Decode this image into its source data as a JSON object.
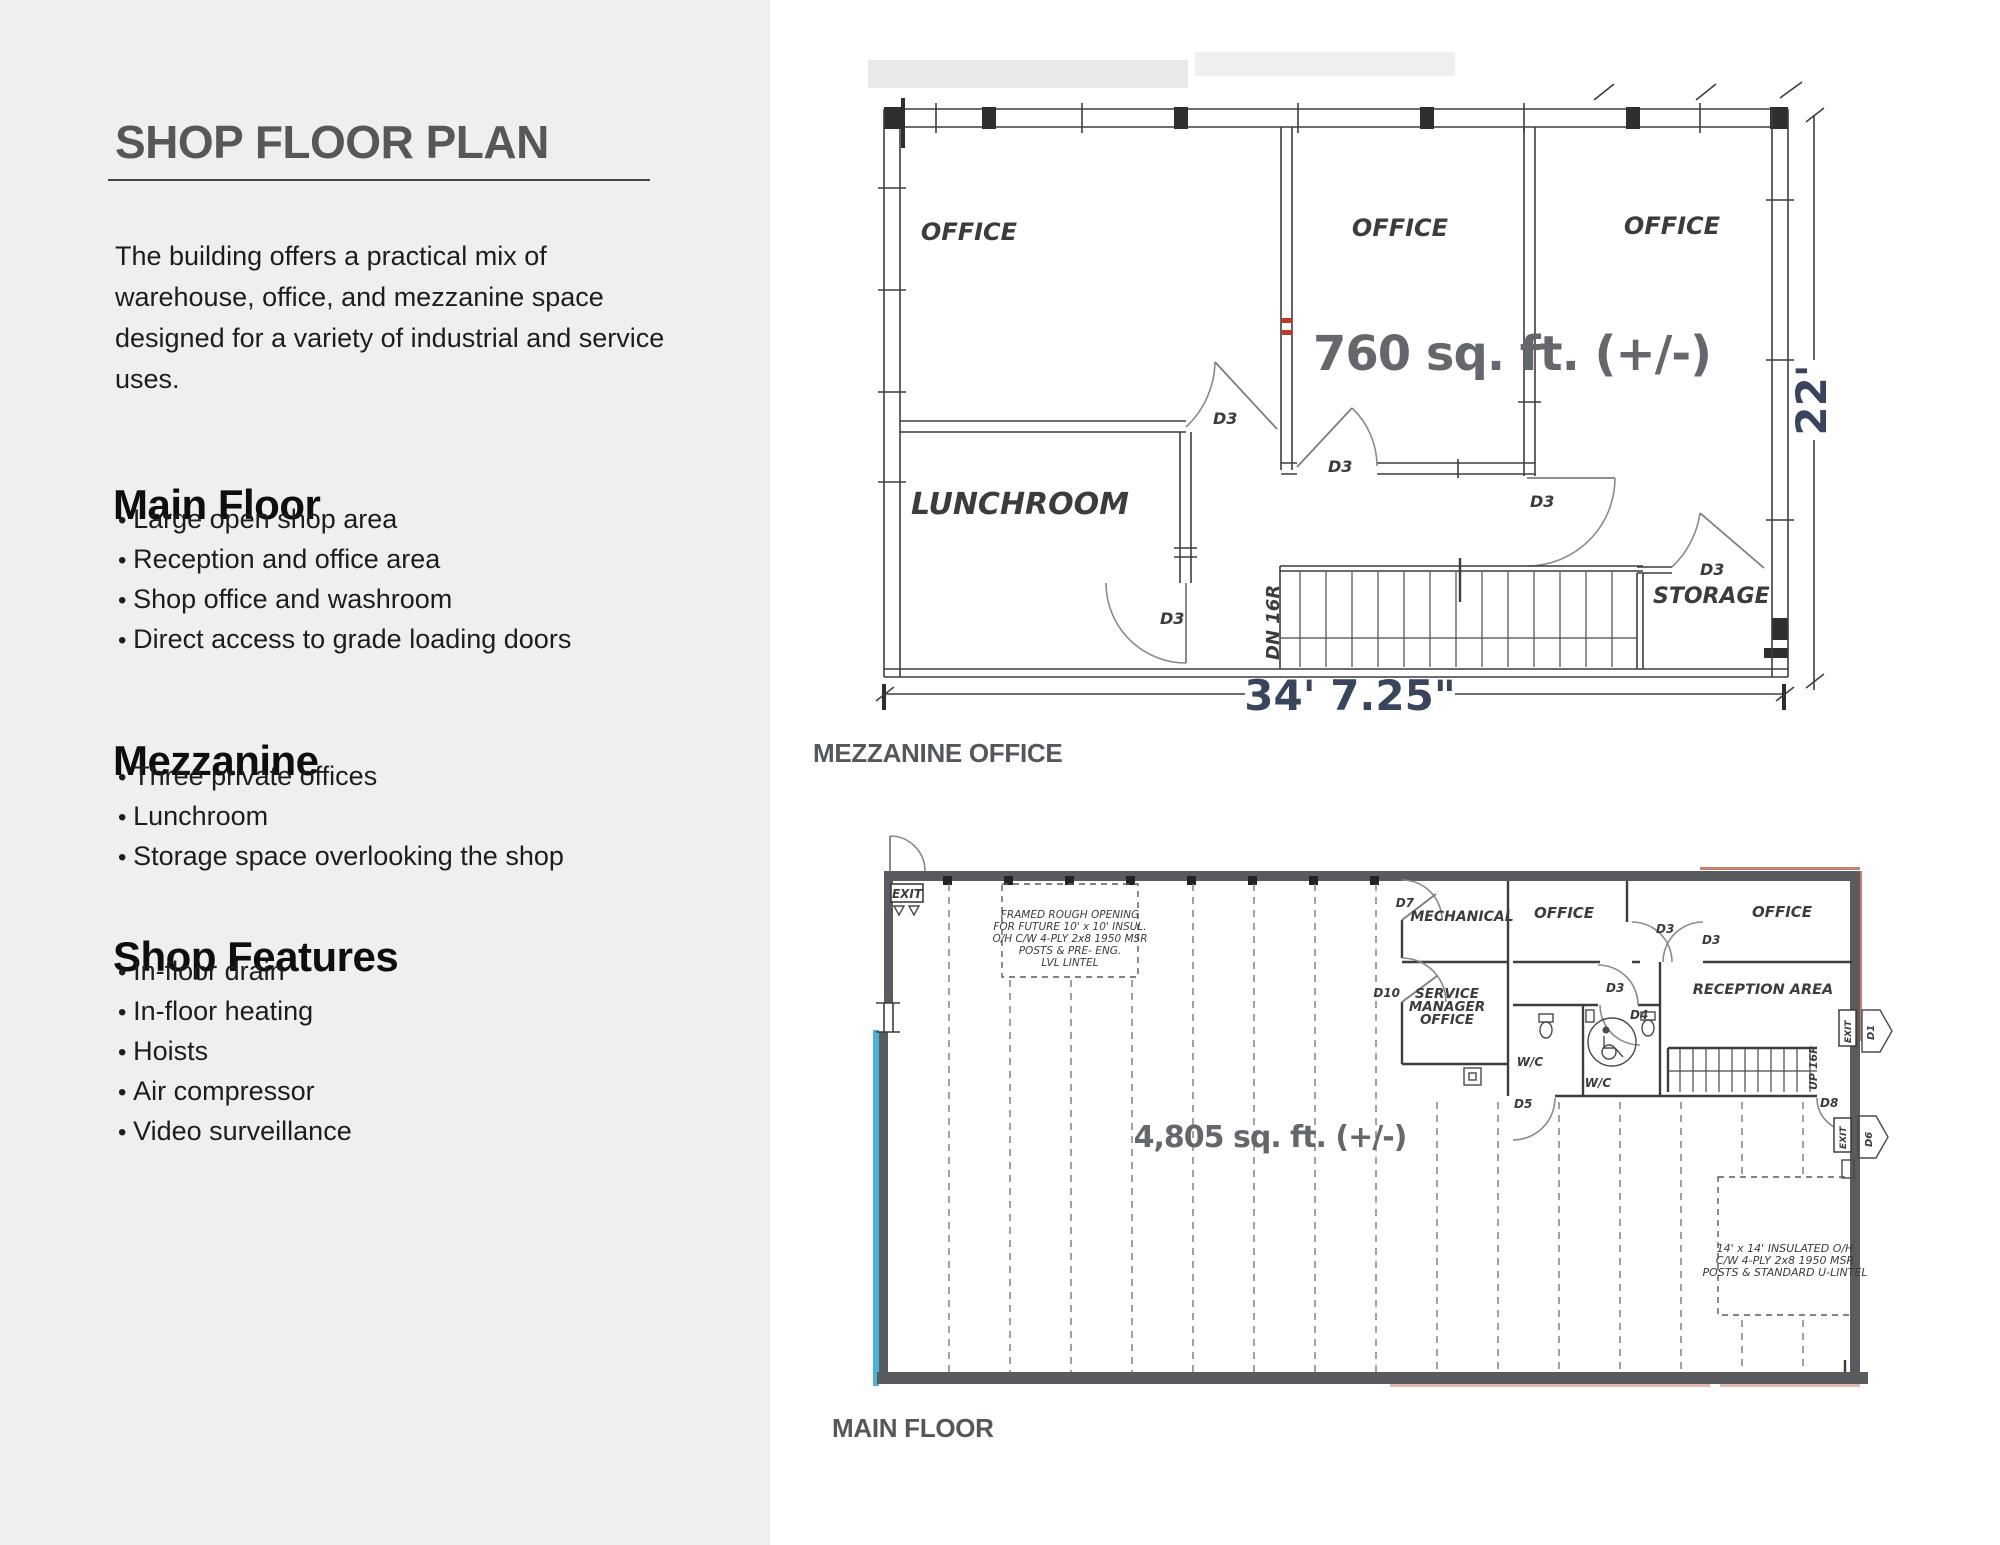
{
  "sidebar": {
    "title": "SHOP FLOOR PLAN",
    "intro_lines": [
      "The building offers a practical mix of",
      "warehouse, office, and mezzanine space",
      "designed for a variety of industrial and service",
      "uses."
    ],
    "sections": [
      {
        "heading": "Main Floor",
        "items": [
          "Large open shop area",
          "Reception and office area",
          "Shop office and washroom",
          "Direct access to grade loading doors"
        ]
      },
      {
        "heading": "Mezzanine",
        "items": [
          "Three private offices",
          "Lunchroom",
          "Storage space overlooking the shop"
        ]
      },
      {
        "heading": "Shop Features",
        "items": [
          "In-floor drain",
          "In-floor heating",
          "Hoists",
          "Air compressor",
          "Video surveillance"
        ]
      }
    ]
  },
  "doors": {
    "d1": "D1",
    "d3": "D3",
    "d4": "D4",
    "d5": "D5",
    "d6": "D6",
    "d7": "D7",
    "d8": "D8",
    "d10": "D10"
  },
  "mezzanine": {
    "caption": "MEZZANINE OFFICE",
    "area": "760 sq. ft. (+/-)",
    "offices": [
      "OFFICE",
      "OFFICE",
      "OFFICE"
    ],
    "lunchroom": "LUNCHROOM",
    "storage": "STORAGE",
    "stairs_label": "DN 16R",
    "width_dim": "34' 7.25\"",
    "height_dim": "22'"
  },
  "main_floor": {
    "caption": "MAIN FLOOR",
    "area": "4,805 sq. ft. (+/-)",
    "mechanical": "MECHANICAL",
    "service_office_lines": [
      "SERVICE",
      "MANAGER",
      "OFFICE"
    ],
    "offices": [
      "OFFICE",
      "OFFICE"
    ],
    "reception": "RECEPTION AREA",
    "wc": "W/C",
    "stairs_label": "UP 16R",
    "exit_label": "EXIT",
    "rough_opening_note": [
      "FRAMED ROUGH OPENING",
      "FOR FUTURE 10' x 10' INSUL.",
      "O/H C/W 4-PLY 2x8 1950 MSR",
      "POSTS & PRE- ENG.",
      "LVL LINTEL"
    ],
    "oh_door_note": [
      "14' x 14' INSULATED O/H",
      "C/W 4-PLY 2x8 1950 MSR",
      "POSTS & STANDARD U-LINTEL"
    ]
  },
  "colors": {
    "sidebar_bg": "#efeff0",
    "accent_cyan": "#45b6da",
    "accent_red": "#c0392b",
    "wall_gray": "#595b5e"
  }
}
